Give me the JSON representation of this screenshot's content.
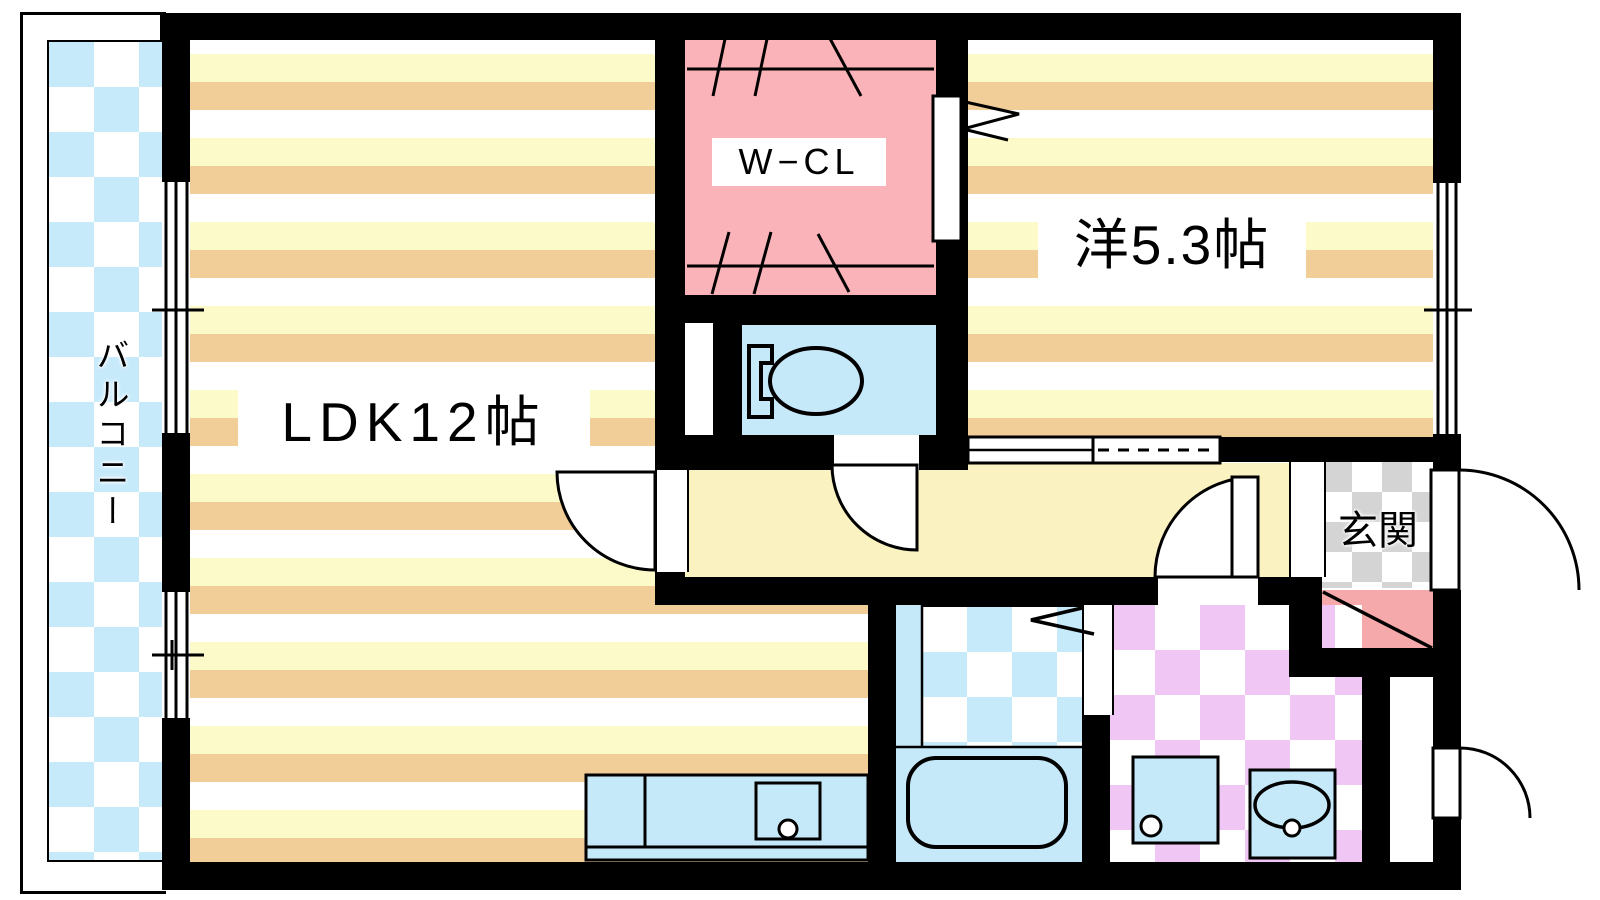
{
  "title": "apartment-floor-plan",
  "labels": {
    "ldk": "LDK12帖",
    "western_room": "洋5.3帖",
    "walk_in_closet": "W−CL",
    "entrance": "玄関",
    "balcony": "バルコニー"
  },
  "colors": {
    "wall": "#000000",
    "floor_stripe_yellow": "#FDFACA",
    "floor_stripe_tan": "#F1CE98",
    "hallway_yellow": "#FBF2C2",
    "closet_pink": "#F9B3B9",
    "shoe_cabinet_pink": "#F5A9AB",
    "water_area_blue": "#C6E9FA",
    "balcony_blue": "#C7EAFB",
    "washroom_purple": "#F0C6F4",
    "entrance_gray": "#D4D4D4"
  },
  "fixtures": [
    "toilet-icon",
    "bathtub-icon",
    "kitchen-counter",
    "kitchen-sink",
    "washing-machine-icon",
    "vanity-sink-icon",
    "hanger-rod-icon",
    "sliding-door",
    "folding-door-icon",
    "shoe-cabinet",
    "swing-door-arc",
    "window-double-sliding"
  ]
}
